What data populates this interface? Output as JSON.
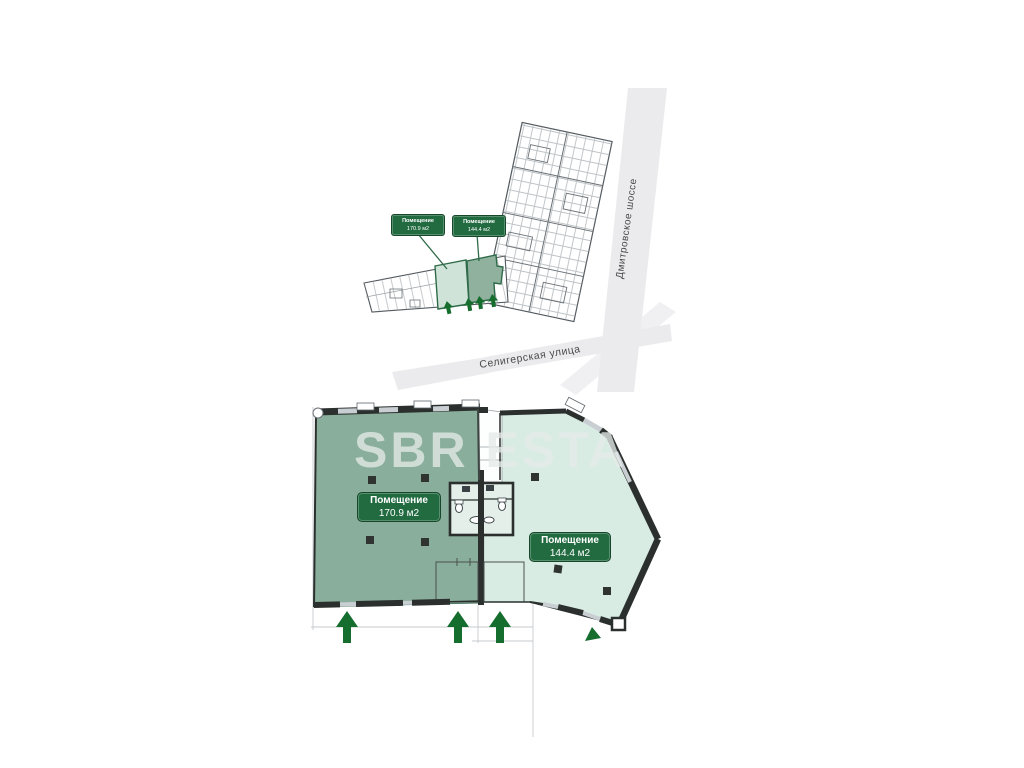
{
  "watermark": {
    "text": "SBR ESTA"
  },
  "site_map": {
    "unit_labels": [
      {
        "title": "Помещение",
        "area": "170.9 м2"
      },
      {
        "title": "Помещение",
        "area": "144.4 м2"
      }
    ],
    "streets": [
      {
        "name": "Дмитровское шоссе"
      },
      {
        "name": "Селигерская улица"
      }
    ]
  },
  "floor_plan": {
    "rooms": [
      {
        "title": "Помещение",
        "area": "170.9 м2"
      },
      {
        "title": "Помещение",
        "area": "144.4 м2"
      }
    ],
    "entrance_arrow_count": 3
  },
  "colors": {
    "room_left_fill": "#8AAE9C",
    "room_right_fill": "#D9ECE4",
    "label_green": "#226B41",
    "outline_green": "#2E6B48",
    "mini_unit_light": "#CFE3D9",
    "mini_unit_dark": "#8FB19E",
    "wall_dark": "#2B302E",
    "window_gray": "#C9CED3",
    "road_gray": "#EBEBED",
    "arrow_green": "#156D2E"
  }
}
